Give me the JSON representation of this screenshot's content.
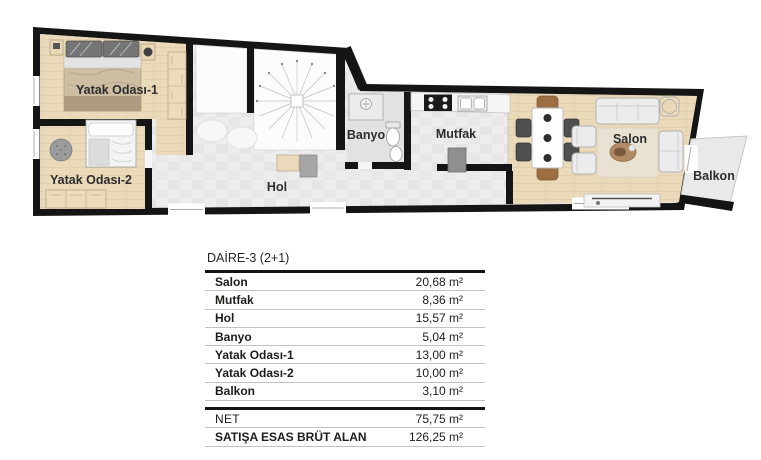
{
  "plan": {
    "labels": {
      "bedroom1": "Yatak Odası-1",
      "bedroom2": "Yatak Odası-2",
      "hall": "Hol",
      "bathroom": "Banyo",
      "kitchen": "Mutfak",
      "living_room": "Salon",
      "balcony": "Balkon"
    },
    "colors": {
      "wall": "#151515",
      "wood_floor": "#eadaba",
      "wood_line": "#d9c49e",
      "tile_floor": "#ededed",
      "tile_alt": "#e4e4e4",
      "bath_floor": "#e2e2e2",
      "white_floor": "#fcfcfc",
      "balcony_floor": "#e9e9e9"
    }
  },
  "table": {
    "title": "DAİRE-3 (2+1)",
    "rows": [
      {
        "label": "Salon",
        "value": "20,68 m²"
      },
      {
        "label": "Mutfak",
        "value": "8,36 m²"
      },
      {
        "label": "Hol",
        "value": "15,57 m²"
      },
      {
        "label": "Banyo",
        "value": "5,04 m²"
      },
      {
        "label": "Yatak Odası-1",
        "value": "13,00 m²"
      },
      {
        "label": "Yatak Odası-2",
        "value": "10,00 m²"
      },
      {
        "label": "Balkon",
        "value": "3,10 m²"
      }
    ],
    "net": {
      "label": "NET",
      "value": "75,75 m²"
    },
    "gross": {
      "label": "SATIŞA ESAS BRÜT ALAN",
      "value": "126,25 m²"
    }
  }
}
